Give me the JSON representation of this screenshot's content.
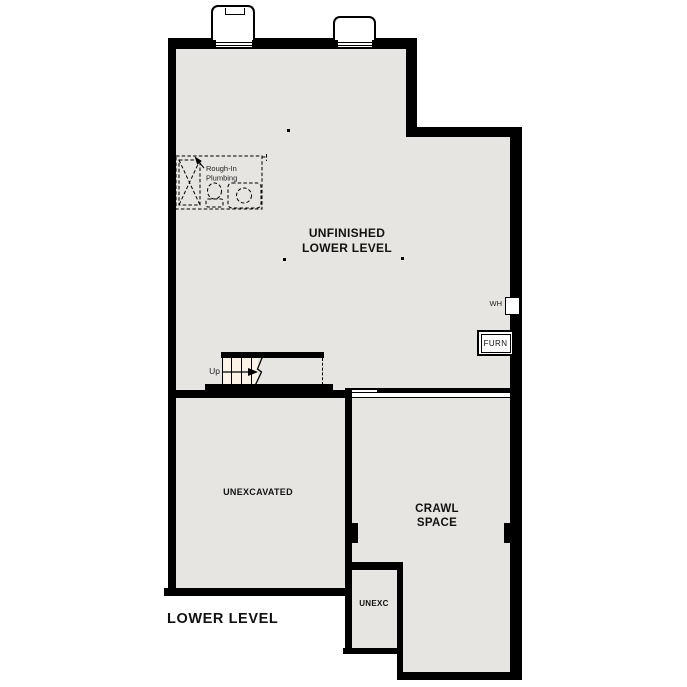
{
  "plan": {
    "title": "LOWER LEVEL",
    "rooms": {
      "main": {
        "line1": "UNFINISHED",
        "line2": "LOWER LEVEL"
      },
      "unexcavated": {
        "label": "UNEXCAVATED"
      },
      "crawl": {
        "line1": "CRAWL",
        "line2": "SPACE"
      },
      "unexc": {
        "label": "UNEXC"
      }
    },
    "equipment": {
      "water_heater": "WH",
      "furnace": "FURN"
    },
    "stairs": {
      "direction_label": "Up"
    },
    "plumbing_note": {
      "line1": "Rough-In",
      "line2": "Plumbing"
    },
    "colors": {
      "floor": "#e6e5e2",
      "wall": "#000000",
      "stair_fill": "#faf3e6",
      "background": "#ffffff"
    }
  }
}
